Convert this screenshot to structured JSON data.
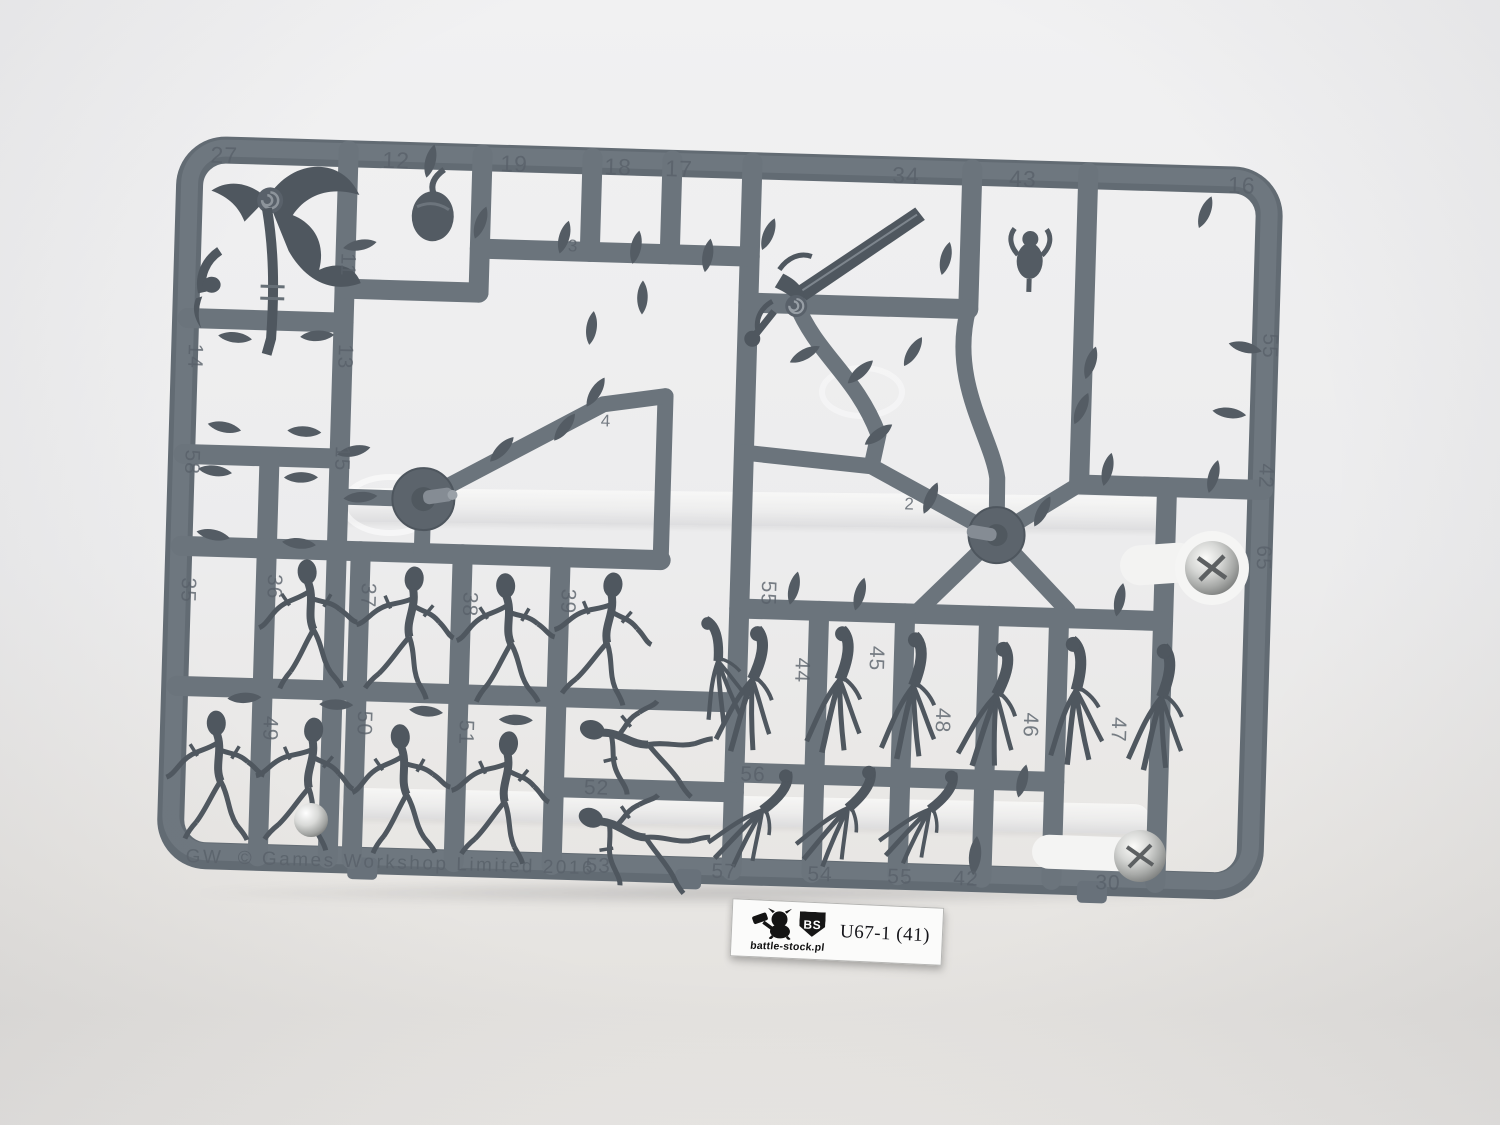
{
  "scene": {
    "subject": "grey plastic model sprue with miniature parts on a clear acrylic stand",
    "colors": {
      "background_top": "#f1f1f2",
      "background_bottom": "#e4e2df",
      "sprue_plastic": "#6b747c",
      "sprue_shadow_edge": "#59616a",
      "parts_dark": "#4f575f",
      "metal_silver": "#c9cac8",
      "acrylic_white": "#f3f3f2",
      "label_background": "#fbfbfa",
      "label_text": "#15151a"
    }
  },
  "sprue": {
    "copyright": "© Games Workshop Limited 2016",
    "maker_mark": "GW",
    "part_numbers": [
      "27",
      "12",
      "19",
      "18",
      "17",
      "34",
      "43",
      "16",
      "14",
      "11",
      "13",
      "58",
      "15",
      "35",
      "36",
      "37",
      "38",
      "39",
      "3",
      "4",
      "2",
      "49",
      "50",
      "51",
      "52",
      "53",
      "55",
      "44",
      "45",
      "48",
      "46",
      "47",
      "56",
      "57",
      "54",
      "55",
      "42",
      "30",
      "55",
      "42",
      "65"
    ]
  },
  "label": {
    "code": "U67-1 (41)",
    "website": "battle-stock.pl",
    "logo_initials": "BS"
  }
}
